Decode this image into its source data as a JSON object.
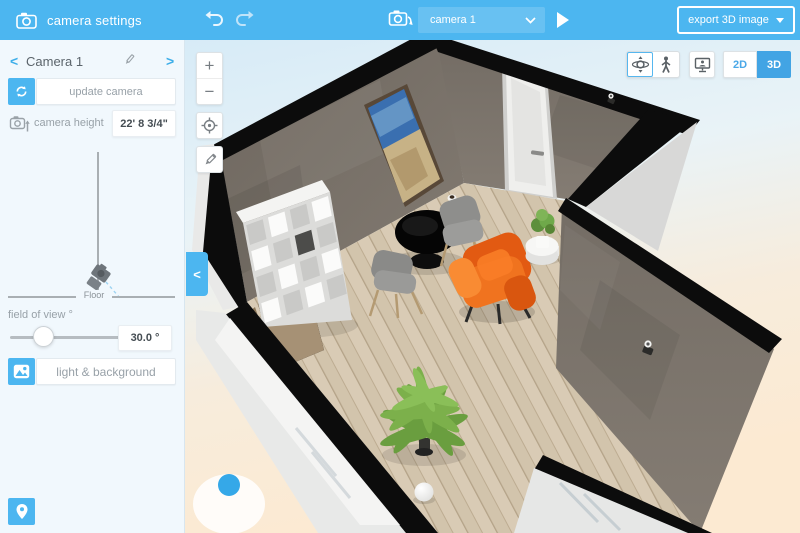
{
  "sidebar": {
    "header": {
      "title": "camera settings"
    },
    "camera": {
      "prev": "<",
      "name": "Camera 1",
      "next": ">"
    },
    "update_camera": {
      "label": "update camera"
    },
    "camera_height": {
      "label": "camera height",
      "value": "22' 8 3/4\""
    },
    "height_diagram": {
      "floor_label": "Floor"
    },
    "fov": {
      "label": "field of view °",
      "value": "30.0 °"
    },
    "light_background": {
      "label": "light & background"
    }
  },
  "toolbar": {
    "camera_dropdown": {
      "value": "camera 1"
    },
    "export": {
      "label": "export 3D image"
    }
  },
  "viewport": {
    "zoom_in": "+",
    "zoom_out": "−",
    "collapse": "<",
    "modes": {
      "d2": "2D",
      "d3": "3D"
    }
  },
  "colors": {
    "accent_blue": "#4cb6f0",
    "selected_3d": "#42a4e4",
    "wall_gray": "#78716a",
    "floor_wood": "#d3c5ae",
    "armchair_orange": "#ee6a1d"
  }
}
